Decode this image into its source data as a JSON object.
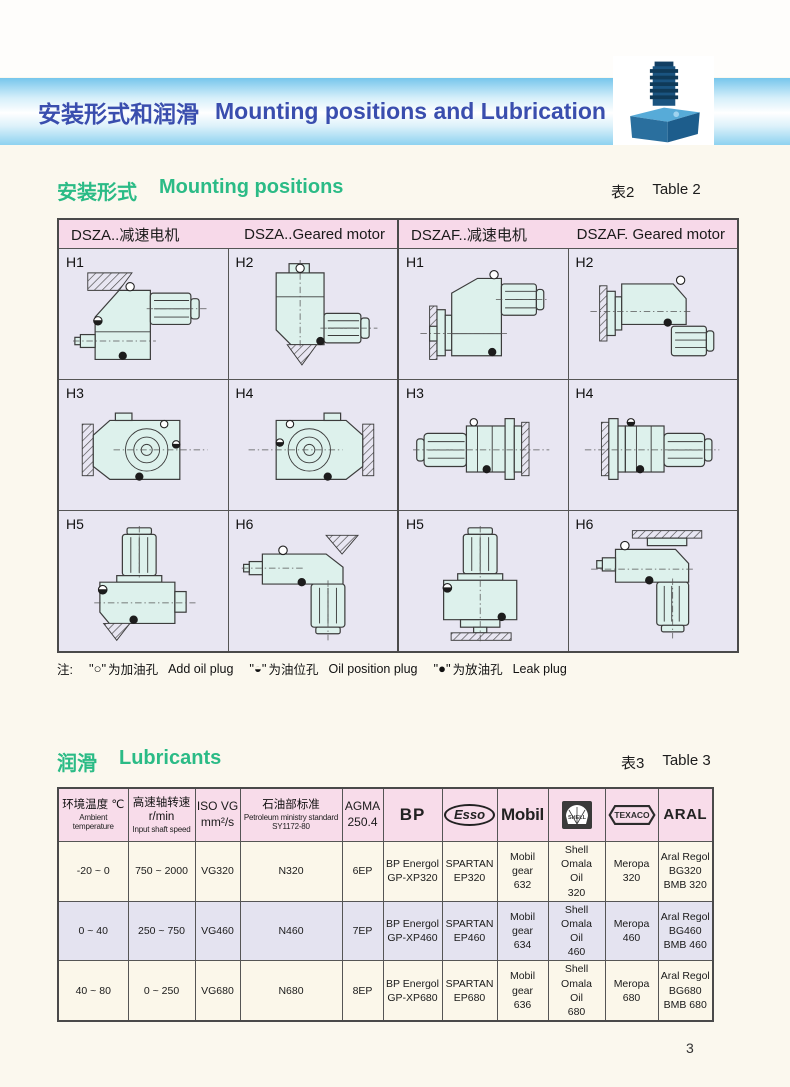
{
  "page": {
    "number": "3"
  },
  "header": {
    "title_zh": "安装形式和润滑",
    "title_en": "Mounting positions and Lubrication"
  },
  "section_mounting": {
    "title_zh": "安装形式",
    "title_en": "Mounting positions",
    "table_ref_zh": "表2",
    "table_ref_en": "Table 2"
  },
  "table2": {
    "header": [
      {
        "zh": "DSZA..减速电机",
        "en": "DSZA..Geared motor"
      },
      {
        "zh": "DSZAF..减速电机",
        "en": "DSZAF. Geared motor"
      }
    ],
    "cells": [
      {
        "label": "H1"
      },
      {
        "label": "H2"
      },
      {
        "label": "H1"
      },
      {
        "label": "H2"
      },
      {
        "label": "H3"
      },
      {
        "label": "H4"
      },
      {
        "label": "H3"
      },
      {
        "label": "H4"
      },
      {
        "label": "H5"
      },
      {
        "label": "H6"
      },
      {
        "label": "H5"
      },
      {
        "label": "H6"
      }
    ]
  },
  "note": {
    "prefix": "注:",
    "items": [
      {
        "sym": "\"○\"",
        "zh": "为加油孔",
        "en": "Add oil plug"
      },
      {
        "sym": "\"◒\"",
        "zh": "为油位孔",
        "en": "Oil position plug"
      },
      {
        "sym": "\"●\"",
        "zh": "为放油孔",
        "en": "Leak plug"
      }
    ]
  },
  "section_lubricants": {
    "title_zh": "润滑",
    "title_en": "Lubricants",
    "table_ref_zh": "表3",
    "table_ref_en": "Table 3"
  },
  "table3": {
    "columns": [
      {
        "zh": "环境温度 ℃",
        "en": "Ambient temperature"
      },
      {
        "zh": "高速轴转速 r/min",
        "en": "Input shaft speed"
      },
      {
        "text": "ISO VG\nmm²/s"
      },
      {
        "zh": "石油部标准",
        "en": "Petroleum ministry standard",
        "en2": "SY1172-80"
      },
      {
        "text": "AGMA\n250.4"
      },
      {
        "logo": "BP"
      },
      {
        "logo": "Esso"
      },
      {
        "logo": "Mobil"
      },
      {
        "logo": "SHELL"
      },
      {
        "logo": "TEXACO"
      },
      {
        "logo": "ARAL"
      }
    ],
    "rows": [
      {
        "cells": [
          "-20 ~ 0",
          "750 ~ 2000",
          "VG320",
          "N320",
          "6EP",
          "BP Energol\nGP-XP320",
          "SPARTAN\nEP320",
          "Mobil gear\n632",
          "Shell Omala\nOil\n320",
          "Meropa\n320",
          "Aral Regol\nBG320\nBMB 320"
        ]
      },
      {
        "cells": [
          "0 ~ 40",
          "250 ~ 750",
          "VG460",
          "N460",
          "7EP",
          "BP Energol\nGP-XP460",
          "SPARTAN\nEP460",
          "Mobil gear\n634",
          "Shell Omala\nOil\n460",
          "Meropa\n460",
          "Aral Regol\nBG460\nBMB 460"
        ]
      },
      {
        "cells": [
          "40 ~ 80",
          "0 ~ 250",
          "VG680",
          "N680",
          "8EP",
          "BP Energol\nGP-XP680",
          "SPARTAN\nEP680",
          "Mobil gear\n636",
          "Shell Omala\nOil\n680",
          "Meropa\n680",
          "Aral Regol\nBG680\nBMB 680"
        ]
      }
    ]
  },
  "colors": {
    "band_blue": "#76c6ec",
    "title_blue": "#3a4eae",
    "section_green": "#2bbb86",
    "table_header_pink": "#f7d9e9",
    "cell_lavender": "#e8e6f2",
    "row_cream": "#fbf7ea",
    "row_lavender": "#e4e3f0",
    "diagram_fill": "#ddf1ec"
  }
}
